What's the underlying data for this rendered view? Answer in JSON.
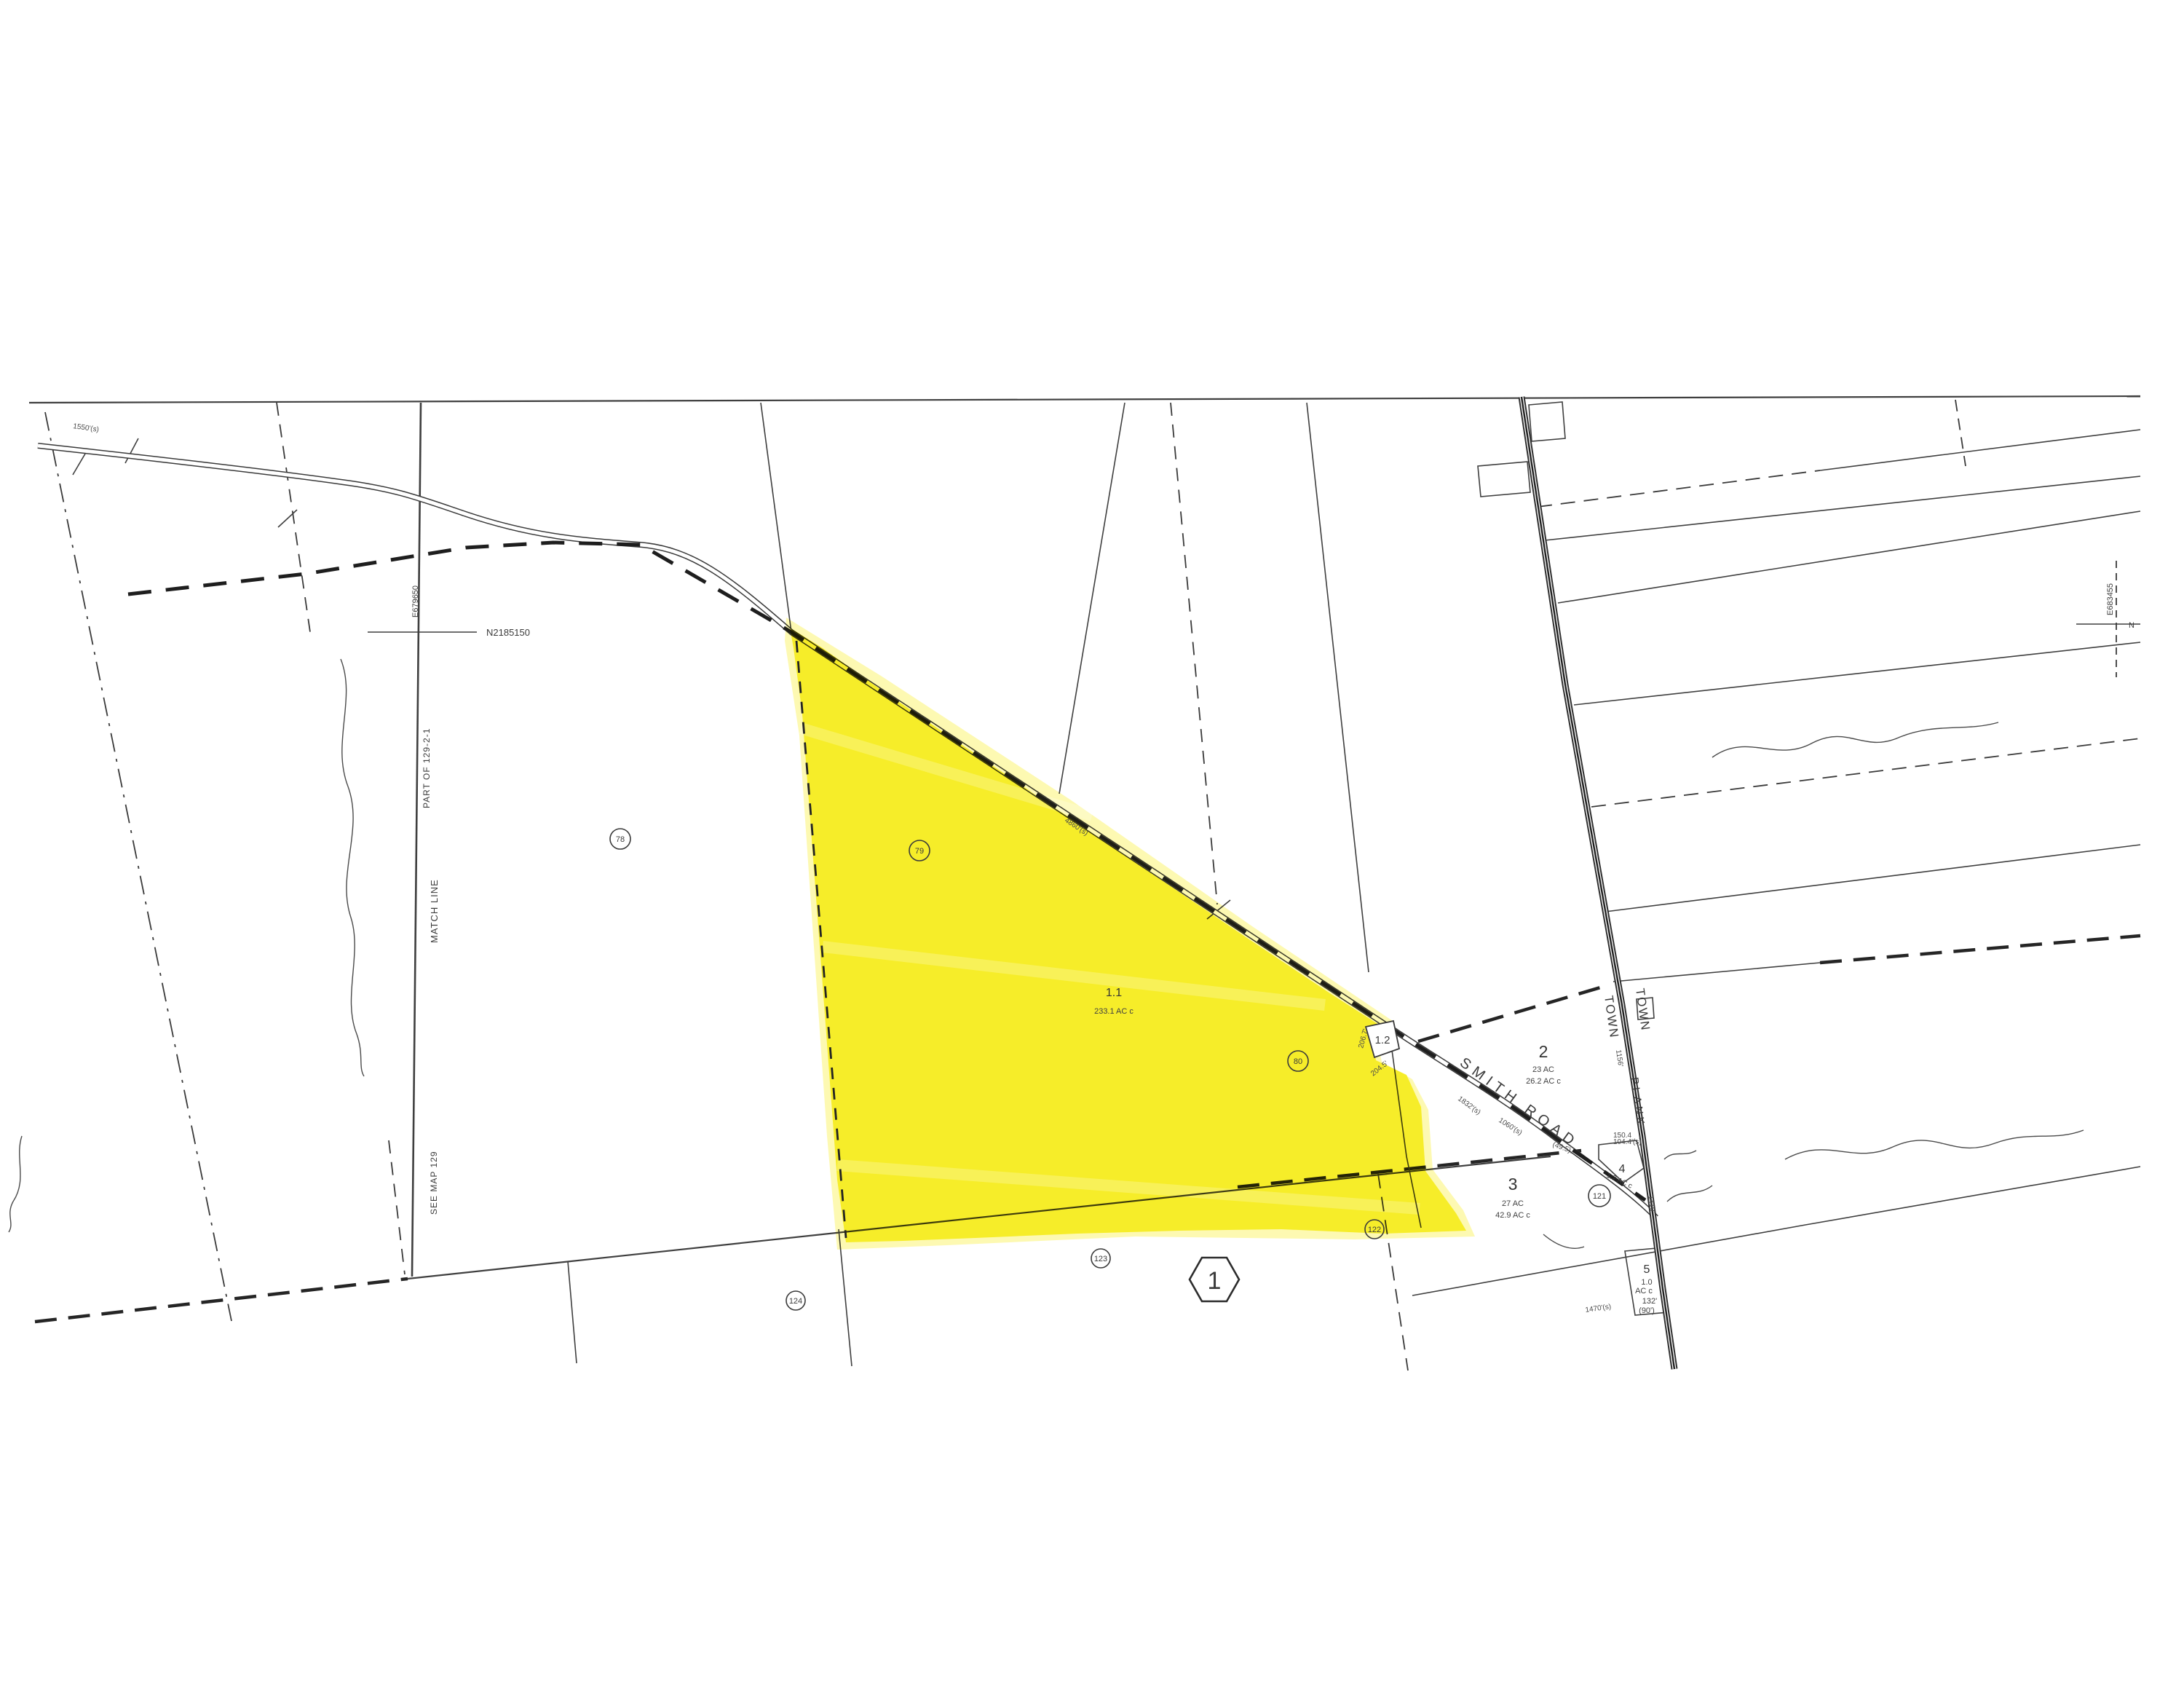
{
  "map": {
    "colors": {
      "paper": "#ffffff",
      "line": "#3f3f3f",
      "highlight": "#f6ec17",
      "highlight_halo": "#fbf57e"
    },
    "sheet_number": "1",
    "edge_labels": {
      "match_line": "MATCH LINE",
      "see_map": "SEE MAP 129",
      "part_of_parcel": "PART OF 129-2-1"
    },
    "grid_ticks": {
      "left_n": "N2185150",
      "left_e": "E679650",
      "right_e": "E683455",
      "right_n": "N"
    },
    "town_line": {
      "label_west": "TOWN",
      "label_east": "TOWN"
    },
    "roads": {
      "smith": "SMITH ROAD",
      "plank": "PLANK"
    },
    "parcels": {
      "p1_1": {
        "id": "1.1",
        "area": "233.1 AC c"
      },
      "p1_2": {
        "id": "1.2"
      },
      "p2": {
        "id": "2",
        "area_deed": "23 AC",
        "area_calc": "26.2 AC c"
      },
      "p3": {
        "id": "3",
        "area_deed": "27 AC",
        "area_calc": "42.9 AC c"
      },
      "p4": {
        "id": "4",
        "area": "1.2 AC c",
        "dim_top1": "150.4",
        "dim_top2": "104.4'(s)"
      },
      "p5": {
        "id": "5",
        "area_line1": "1.0",
        "area_line2": "AC c",
        "dim1": "132'",
        "dim2": "(90')",
        "dim3": "1470'(s)"
      }
    },
    "lot_numbers": {
      "l78": "78",
      "l79": "79",
      "l80": "80",
      "l121": "121",
      "l122": "122",
      "l123": "123",
      "l124": "124"
    },
    "dimensions": {
      "d1550": "1550'(s)",
      "d4860": "4860'(s)",
      "d1832": "1832'(s)",
      "d1060": "1060'(s)",
      "d49_5": "(49.5)",
      "d1156": "1156'",
      "d1410": "1410'",
      "d206_7": "206.7'",
      "d204_5": "204.5'"
    }
  }
}
